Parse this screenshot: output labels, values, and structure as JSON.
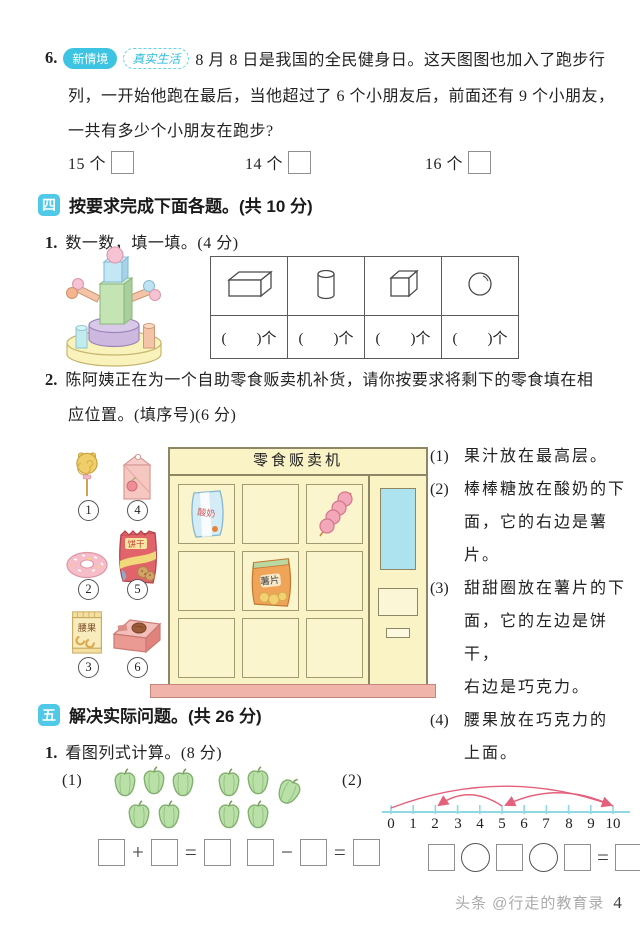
{
  "page": {
    "watermark": "头条 @行走的教育录",
    "number": "4"
  },
  "q6": {
    "num": "6.",
    "badge_new": "新情境",
    "badge_real": "真实生活",
    "lines": [
      "8 月 8 日是我国的全民健身日。这天图图也加入了跑步行",
      "列，一开始他跑在最后，当他超过了 6 个小朋友后，前面还有 9 个小朋友，",
      "一共有多少个小朋友在跑步?"
    ],
    "options": [
      "15 个",
      "14 个",
      "16 个"
    ]
  },
  "section4": {
    "badge": "四",
    "title": "按要求完成下面各题。(共 10 分)",
    "q1": {
      "num": "1.",
      "title": "数一数，填一填。(4 分)",
      "unit_cell": "(        )个",
      "shapes": [
        "cuboid",
        "cylinder",
        "cube",
        "sphere"
      ]
    },
    "q2": {
      "num": "2.",
      "lines": [
        "陈阿姨正在为一个自助零食贩卖机补货，请你按要求将剩下的零食填在相",
        "应位置。(填序号)(6 分)"
      ],
      "snacks": [
        {
          "id": "1",
          "name": "lollipop"
        },
        {
          "id": "4",
          "name": "juice carton"
        },
        {
          "id": "2",
          "name": "donut"
        },
        {
          "id": "5",
          "name": "cookie bag",
          "label": "饼干"
        },
        {
          "id": "3",
          "name": "cashew bag",
          "label": "腰果"
        },
        {
          "id": "6",
          "name": "chocolate box"
        }
      ],
      "machine": {
        "title": "零食贩卖机",
        "yogurt_label": "酸奶",
        "chips_label": "薯片"
      },
      "clues": [
        {
          "num": "(1)",
          "lines": [
            "果汁放在最高层。"
          ]
        },
        {
          "num": "(2)",
          "lines": [
            "棒棒糖放在酸奶的下",
            "面，它的右边是薯片。"
          ]
        },
        {
          "num": "(3)",
          "lines": [
            "甜甜圈放在薯片的下",
            "面，它的左边是饼干，",
            "右边是巧克力。"
          ]
        },
        {
          "num": "(4)",
          "lines": [
            "腰果放在巧克力的",
            "上面。"
          ]
        }
      ]
    }
  },
  "section5": {
    "badge": "五",
    "title": "解决实际问题。(共 26 分)",
    "q1": {
      "num": "1.",
      "title": "看图列式计算。(8 分)",
      "part1": {
        "label": "(1)",
        "plus": "+",
        "minus": "−",
        "equals": "=",
        "peppers_left": 5,
        "peppers_right": 5
      },
      "part2": {
        "label": "(2)",
        "equals": "=",
        "ticks": [
          "0",
          "1",
          "2",
          "3",
          "4",
          "5",
          "6",
          "7",
          "8",
          "9",
          "10"
        ],
        "arcs": [
          {
            "from": 0,
            "to": 10
          },
          {
            "from": 10,
            "to": 5
          },
          {
            "from": 5,
            "to": 2
          }
        ]
      }
    }
  }
}
